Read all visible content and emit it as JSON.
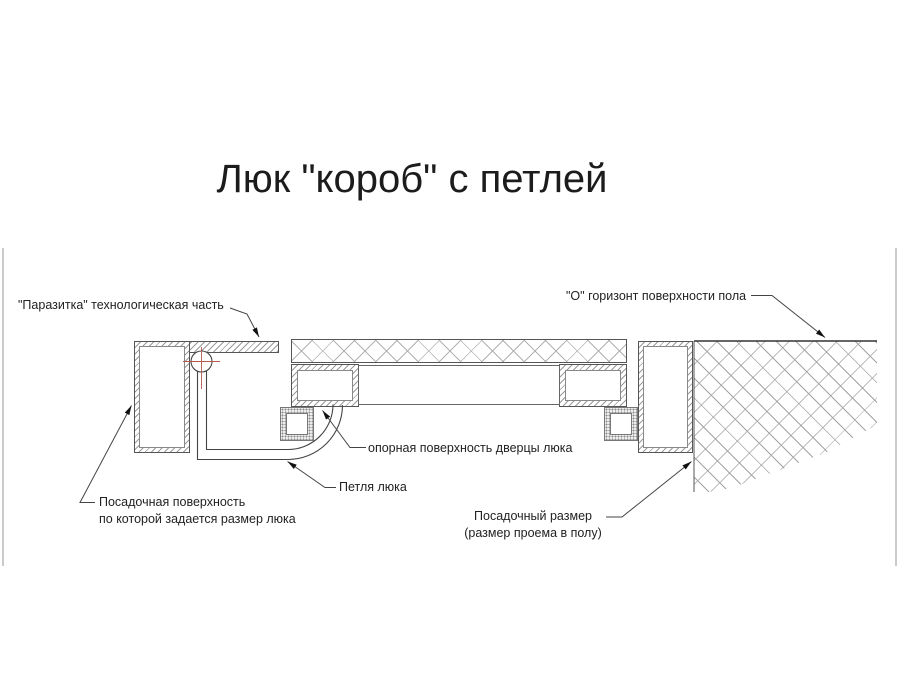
{
  "title": "Люк \"короб\" с петлей",
  "labels": {
    "parasitka": "\"Паразитка\" технологическая часть",
    "floor_horizon": "\"О\" горизонт поверхности пола",
    "door_support": "опорная поверхность дверцы люка",
    "hinge": "Петля люка",
    "seating_surface_line1": "Посадочная поверхность",
    "seating_surface_line2": "по которой задается размер люка",
    "seating_size_line1": "Посадочный размер",
    "seating_size_line2": "(размер проема в полу)"
  },
  "colors": {
    "drawing_line": "#444444",
    "hatch_gray": "#a8a8a8",
    "centerline_red": "#b4584e",
    "viewer_edge_gray": "#cbcbcb"
  }
}
